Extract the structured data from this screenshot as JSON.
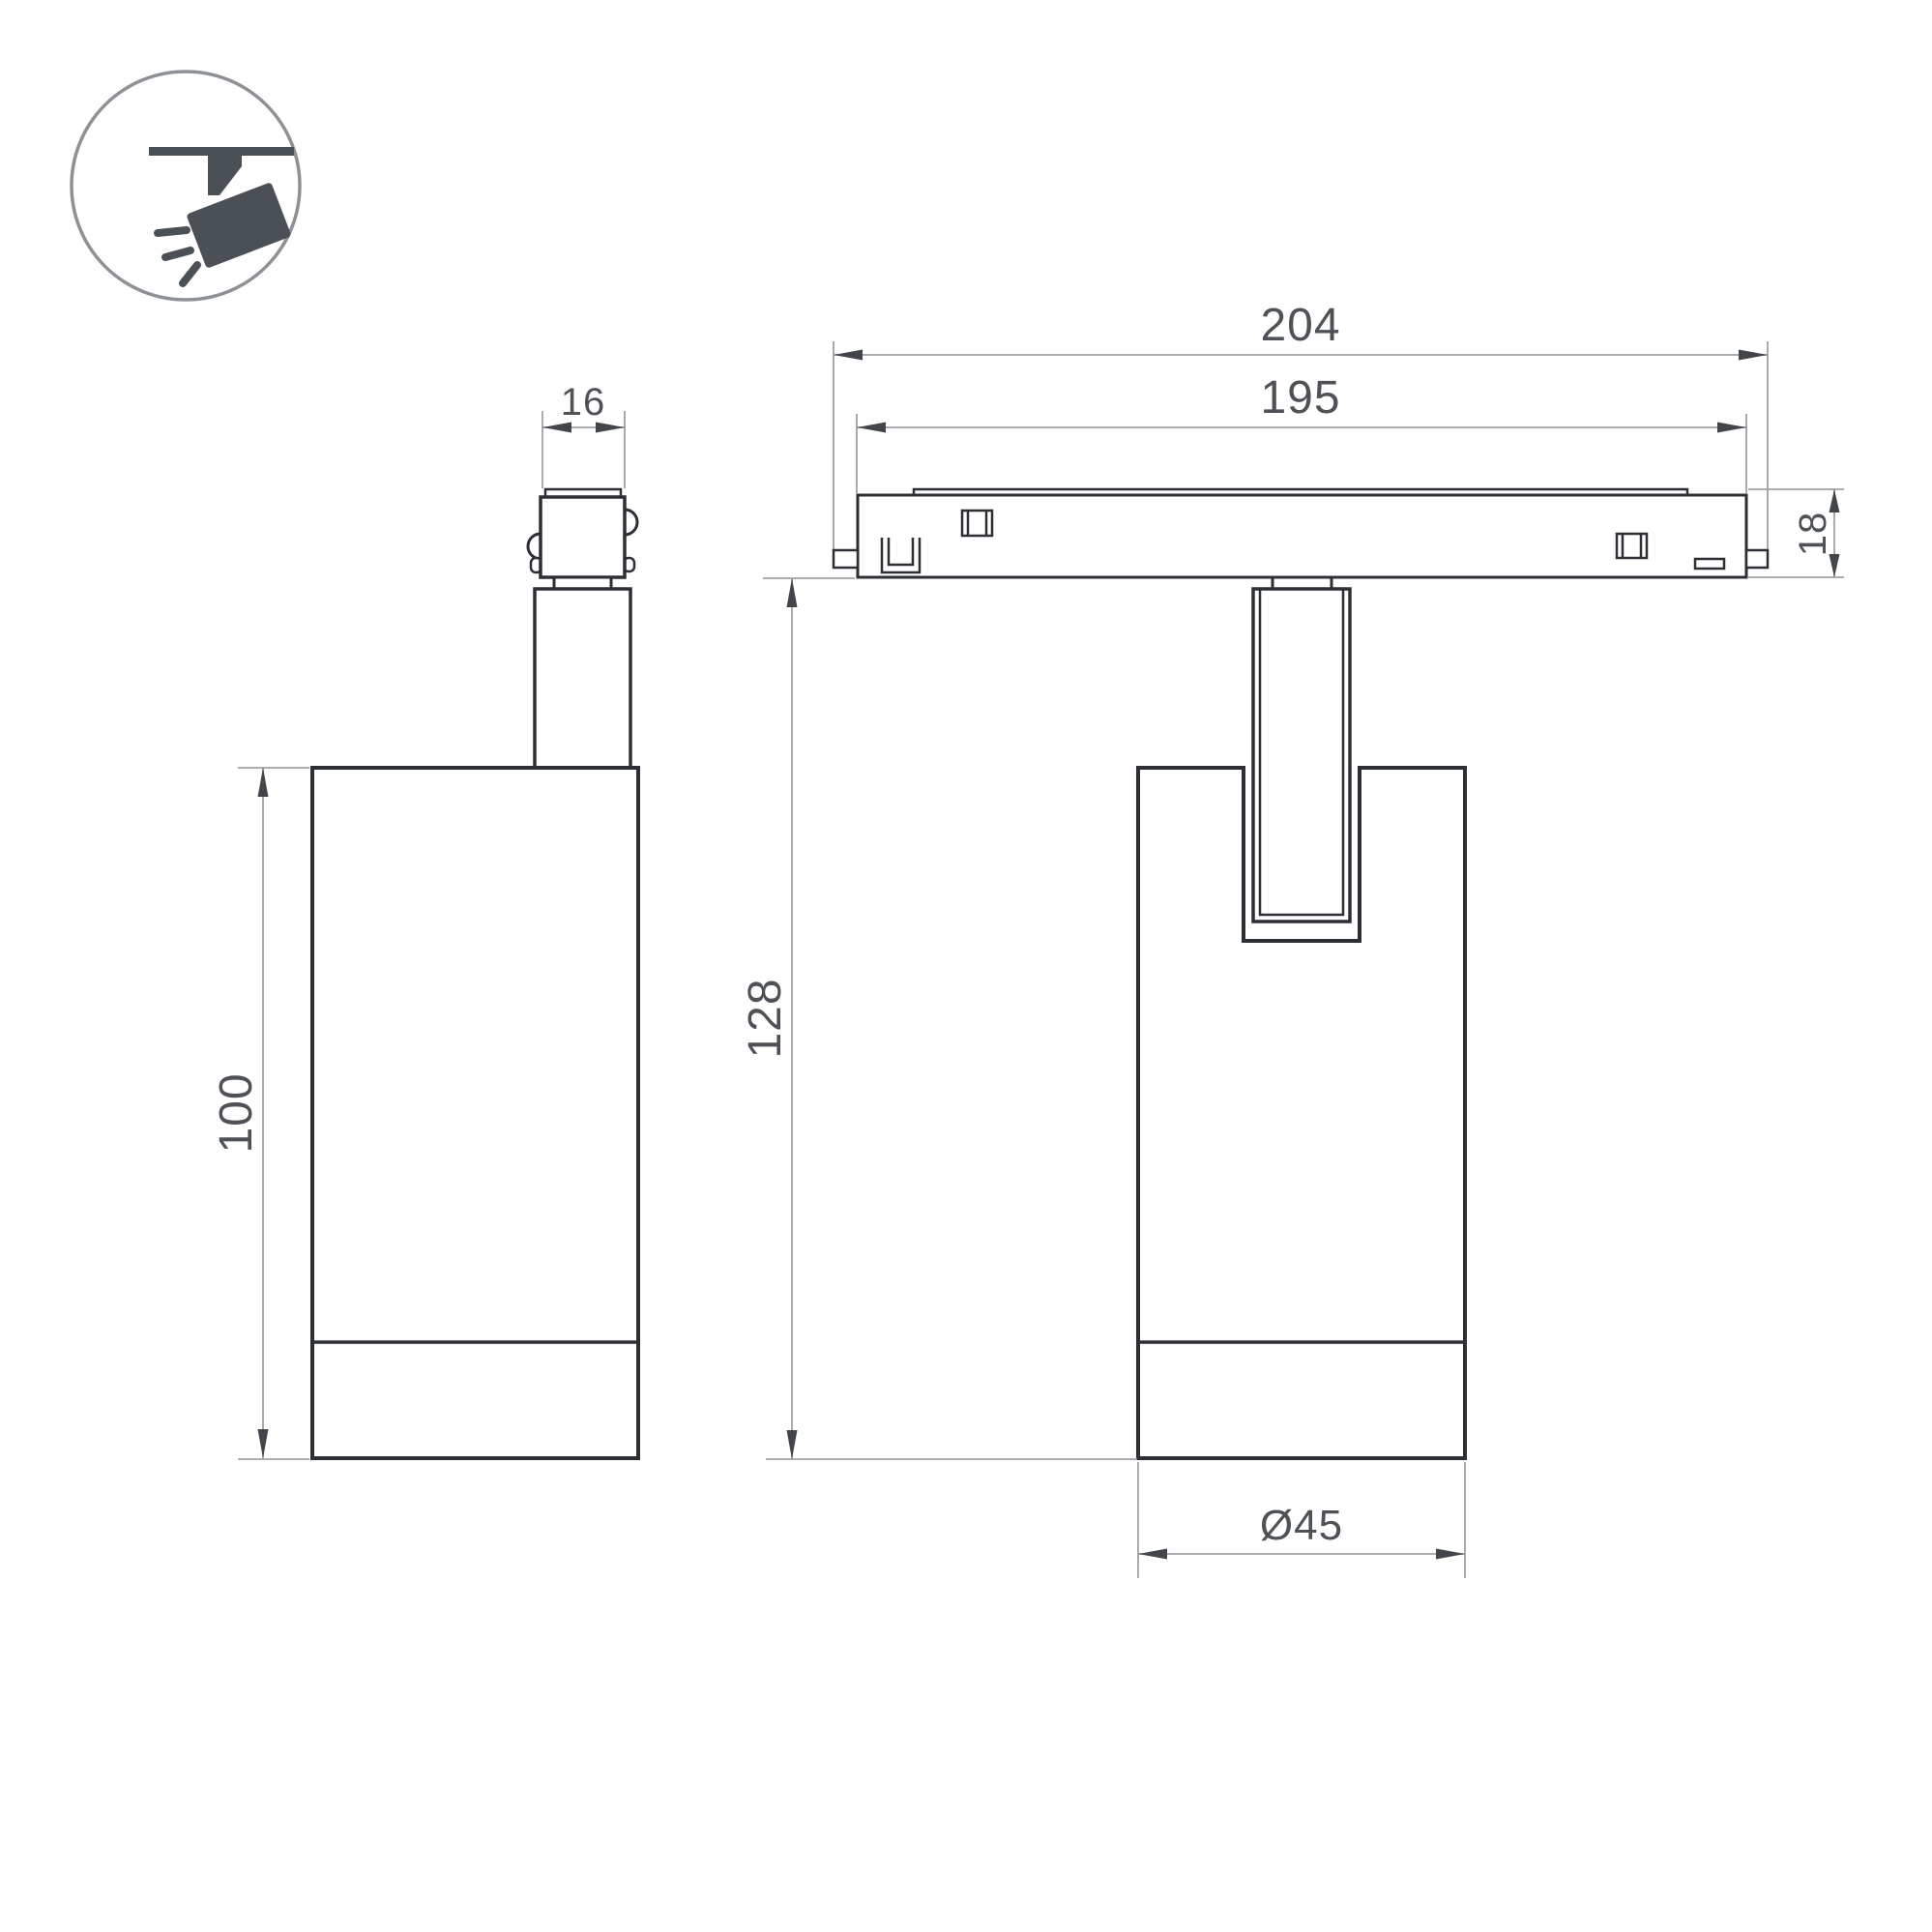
{
  "page": {
    "background": "#ffffff"
  },
  "colors": {
    "object_line": "#2c2f33",
    "dimension_line": "#9fa2a5",
    "arrow": "#42464a",
    "text": "#4e5257",
    "icon_circle": "#8d9195",
    "icon_glyph": "#4a5056"
  },
  "icon": {
    "name": "track-spotlight-icon"
  },
  "views": {
    "side": {
      "dims": {
        "adapter_width": {
          "label": "16"
        },
        "body_height": {
          "label": "100"
        }
      }
    },
    "front": {
      "dims": {
        "track_overall_length": {
          "label": "204"
        },
        "track_inner_length": {
          "label": "195"
        },
        "track_height": {
          "label": "18"
        },
        "fixture_drop_height": {
          "label": "128"
        },
        "body_diameter": {
          "label": "Ø45"
        }
      }
    }
  }
}
